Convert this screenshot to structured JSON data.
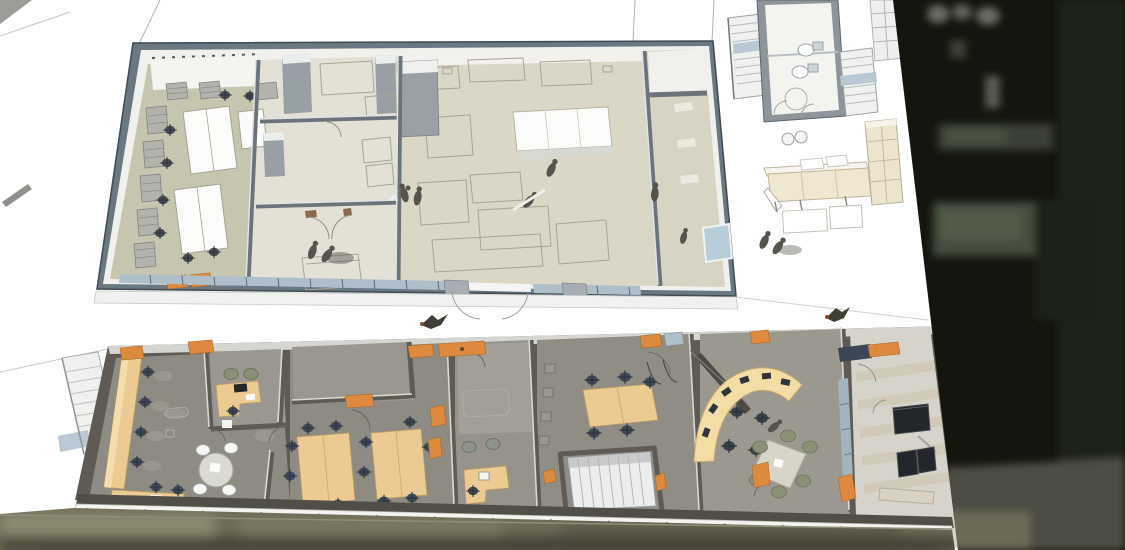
{
  "meta": {
    "scene": "Aerial axonometric 3D architectural rendering (SketchUp-style) of a two-wing building floor plan, composited over a dark rooftop aerial photo on the right edge and a street pavement photo strip along the bottom",
    "canvas": {
      "width": 1125,
      "height": 550
    },
    "visible_text": "none"
  },
  "colors": {
    "background": "#ffffff",
    "wall_face": "#6a7882",
    "wall_edge": "#3f4a53",
    "wall_inner_white": "#f0f0ed",
    "wall_cap": "#d5d6d2",
    "inner_wall_gray": "#99a0a5",
    "partition_upper": "#6b737b",
    "partition_cap": "#e2e4e5",
    "floor_sage": "#c6c5b0",
    "floor_beige": "#dbd7c6",
    "floor_pale": "#e3e0d6",
    "floor_gray": "#8e8b83",
    "floor_gray_light": "#9a9790",
    "floor_lounge": "#d6d3ca",
    "lower_wall_dark": "#55524b",
    "partition_lower": "#5f5b54",
    "desk_tan": "#eccb92",
    "desk_tan_edge": "#c09d66",
    "console_cream": "#f3dca6",
    "table_white": "#fafaf8",
    "chair_dark": "#3f4855",
    "chair_olive": "#8b9177",
    "accent_orange": "#dd8a3e",
    "accent_orange_edge": "#a96a28",
    "glass_blue": "#aebfca",
    "window_blue": "#b9cdd8",
    "outline": "#a8a593",
    "silhouette": "#55544c",
    "stairs_white": "#f0f1ef",
    "photo_dark": "#14150e",
    "photo_patch": "#46503e",
    "photo_strip": "#6f6d59",
    "facade_white": "#f3f3f0"
  },
  "inventory": {
    "upper_wing": {
      "name": "upper-studio-wing",
      "rooms": [
        {
          "name": "workshop-left",
          "floor": "sage",
          "furniture": [
            "wall-shelving-row",
            "wall-shelving-column",
            "two-white-worktables",
            "side-table",
            "office-chairs"
          ]
        },
        {
          "name": "small-room-top",
          "floor": "pale-beige",
          "furniture": [
            "gray-wardrobe",
            "outlined-rug"
          ]
        },
        {
          "name": "entry-hall",
          "floor": "pale-beige",
          "furniture": [
            "shelf-outlines",
            "leaning-rod"
          ]
        },
        {
          "name": "small-room-bottom",
          "floor": "pale-beige",
          "furniture": [
            "outlined-bed",
            "double-door-swing"
          ],
          "people": 2
        },
        {
          "name": "main-studio",
          "floor": "beige",
          "furniture": [
            "white-counter-island",
            "outlined-benches-and-tables",
            "gray-cabinet"
          ],
          "people": 3
        },
        {
          "name": "corridor-right",
          "floor": "beige",
          "features": [
            "blue-window",
            "wall-ledges"
          ],
          "people": 2
        }
      ],
      "exterior": [
        "glazed-south-wall",
        "white-sill-band",
        "double-door-swing"
      ]
    },
    "courtyard": {
      "name": "rear-yard",
      "objects": [
        "stair-flight-left",
        "restroom-two-toilets",
        "round-shower",
        "stair-flight-right",
        "tall-shelf-column",
        "cream-shelf-unit",
        "sideboard-with-paper-roll",
        "two-stools",
        "floor-panels-outline",
        "walking-pair"
      ]
    },
    "lower_wing": {
      "name": "lower-office-wing",
      "rooms": [
        {
          "name": "open-office-left",
          "furniture": [
            "window-counter-desk",
            "six-office-chairs",
            "round-table-four-white-chairs",
            "bottom-desk"
          ]
        },
        {
          "name": "corner-office",
          "furniture": [
            "l-desk-with-monitor",
            "two-olive-chairs"
          ]
        },
        {
          "name": "team-office",
          "furniture": [
            "storage-room",
            "two-four-seat-tables",
            "office-chairs"
          ]
        },
        {
          "name": "small-office",
          "furniture": [
            "reception-desk",
            "computer",
            "two-side-chairs"
          ]
        },
        {
          "name": "conference-room",
          "furniture": [
            "conference-table",
            "office-chairs",
            "wall-shelf-boxes",
            "hanging-door-wires"
          ]
        },
        {
          "name": "stair-hall",
          "furniture": [
            "straight-stair"
          ]
        },
        {
          "name": "control-room",
          "furniture": [
            "curved-console-with-monitors",
            "operator-chairs",
            "meeting-table-six-olive-chairs",
            "diagonal-screen-wall"
          ],
          "people": 1
        },
        {
          "name": "lounge-right",
          "furniture": [
            "navy-bench",
            "black-credenza",
            "two-black-lounge-chairs",
            "glass-screen",
            "light-sideboard"
          ],
          "floor": "striped-light"
        }
      ],
      "exterior": [
        "entry-stair-left",
        "blue-canopy",
        "orange-door-headers",
        "street-facade-band"
      ]
    },
    "aerial_photo": {
      "right": "dark rooftop with blurred skylight patches",
      "bottom": "street pavement strip"
    },
    "figures": {
      "people": 10,
      "birds": 2
    }
  }
}
